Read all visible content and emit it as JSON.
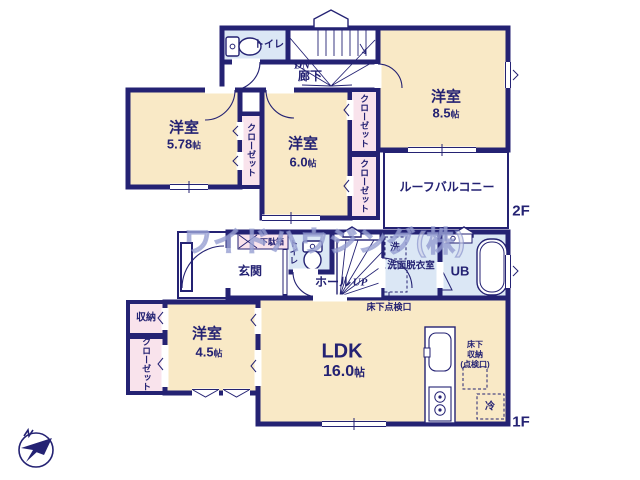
{
  "watermark": {
    "text": "ワイドハウジング(株)"
  },
  "colors": {
    "wall": "#242273",
    "room_cream": "#f9e9c6",
    "closet_pink": "#f9e3ec",
    "wet_blue": "#dbe7f5",
    "text_navy": "#242273"
  },
  "floor2": {
    "floor_label": "2F",
    "toilet": {
      "label": "トイレ"
    },
    "stairs": {
      "label": "DN"
    },
    "hallway": {
      "label": "廊下"
    },
    "bedroom_a": {
      "name": "洋室",
      "size": "8.5",
      "unit": "帖"
    },
    "bedroom_b": {
      "name": "洋室",
      "size": "5.78",
      "unit": "帖"
    },
    "bedroom_c": {
      "name": "洋室",
      "size": "6.0",
      "unit": "帖"
    },
    "closet_a": {
      "label": "クローゼット"
    },
    "closet_b": {
      "label": "クローゼット"
    },
    "closet_c": {
      "label": "クローゼット"
    },
    "balcony": {
      "label": "ルーフバルコニー"
    }
  },
  "floor1": {
    "floor_label": "1F",
    "entrance": {
      "label": "玄関"
    },
    "shoe_cabinet": {
      "label": "下駄箱"
    },
    "toilet": {
      "label": "トイレ"
    },
    "hall": {
      "label": "ホール",
      "stairs_label": "UP"
    },
    "washroom": {
      "label": "洗面脱衣室",
      "washer_label": "洗"
    },
    "bath": {
      "label": "UB"
    },
    "underfloor_hatch": {
      "label": "床下点検口"
    },
    "storage": {
      "label": "収納"
    },
    "closet": {
      "label": "クローゼット"
    },
    "bedroom": {
      "name": "洋室",
      "size": "4.5",
      "unit": "帖"
    },
    "ldk": {
      "name": "LDK",
      "size": "16.0",
      "unit": "帖"
    },
    "underfloor_storage": {
      "line1": "床下",
      "line2": "収納",
      "line3": "(点検口)"
    },
    "refrigerator": {
      "label": "冷"
    }
  },
  "compass": {
    "label": "N"
  }
}
